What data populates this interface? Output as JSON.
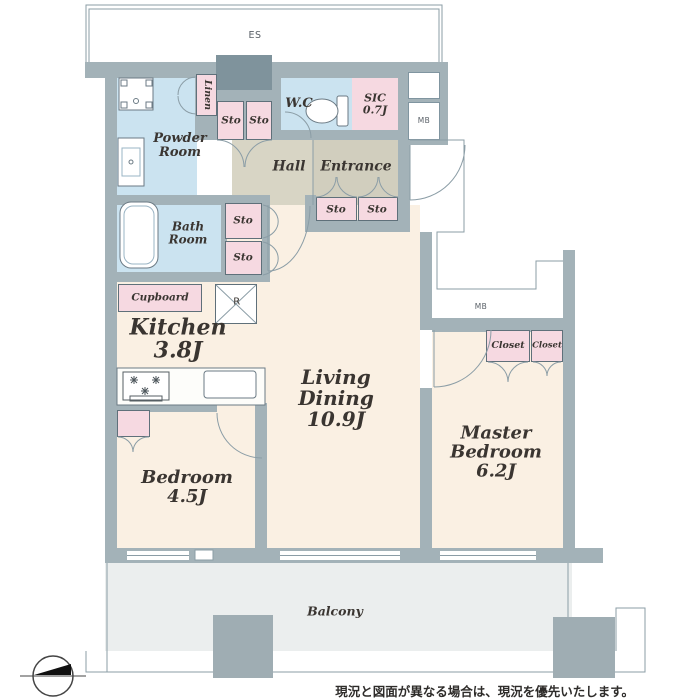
{
  "rooms": {
    "powder": {
      "l1": "Powder",
      "l2": "Room"
    },
    "bath": {
      "l1": "Bath",
      "l2": "Room"
    },
    "wc": "W.C",
    "sic": {
      "name": "SIC",
      "size": "0.7J"
    },
    "hall": "Hall",
    "entrance": "Entrance",
    "kitchen": {
      "name": "Kitchen",
      "size": "3.8J"
    },
    "living_dining": {
      "l1": "Living",
      "l2": "Dining",
      "size": "10.9J"
    },
    "bedroom": {
      "name": "Bedroom",
      "size": "4.5J"
    },
    "master_bedroom": {
      "l1": "Master",
      "l2": "Bedroom",
      "size": "6.2J"
    },
    "balcony": "Balcony"
  },
  "storage": {
    "sto": "Sto",
    "linen": "Linen",
    "closet": "Closet",
    "cupboard": "Cupboard",
    "refrigerator": "R"
  },
  "utility": {
    "mb": "MB",
    "es": "ES"
  },
  "note": "現況と図面が異なる場合は、現況を優先いたします。",
  "colors": {
    "wall": "#a3b2b8",
    "wall_dark_shaft": "#7f939c",
    "wet_room_blue": "#cbe3f0",
    "storage_pink": "#f6d9e1",
    "room_cream": "#faf0e3",
    "hall_beige": "#d8d5c5",
    "balcony_gray": "#ebeeee",
    "line": "#8b9da6",
    "text": "#3a3531"
  }
}
